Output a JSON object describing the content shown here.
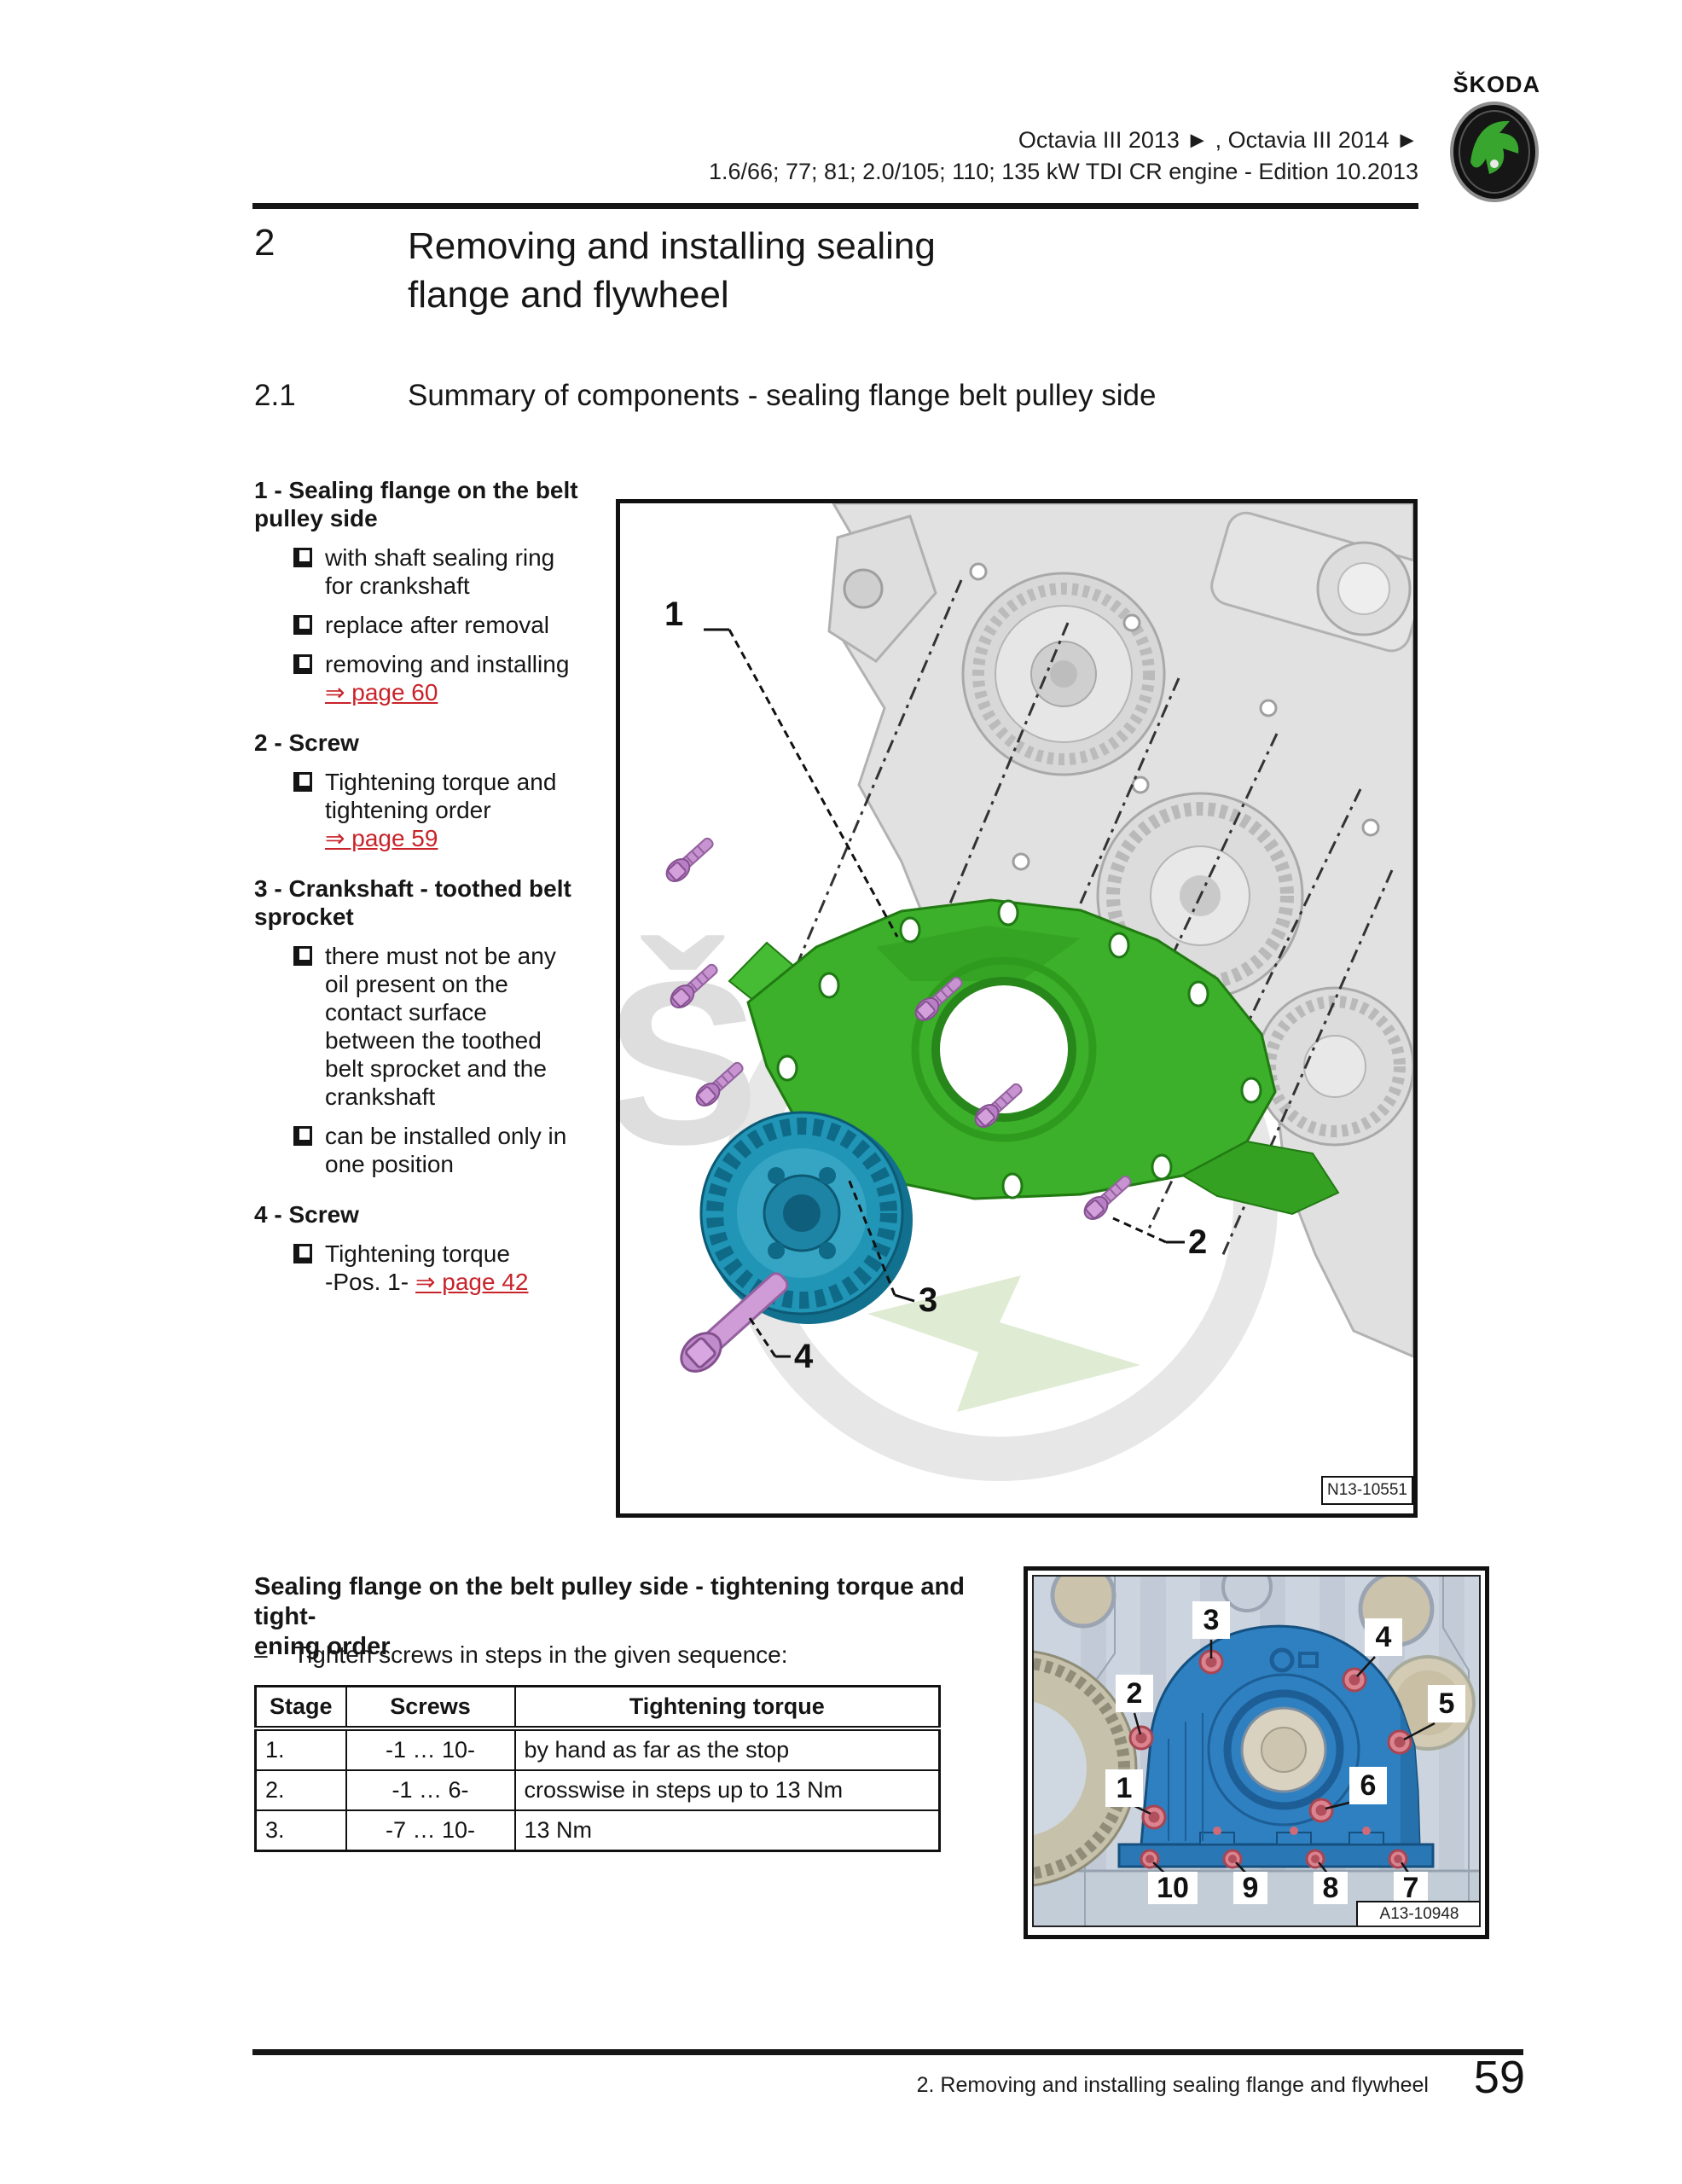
{
  "header": {
    "brand": "ŠKODA",
    "model_line": "Octavia III 2013 ► , Octavia III 2014 ►",
    "engine_line": "1.6/66; 77; 81; 2.0/105; 110; 135 kW TDI CR engine - Edition 10.2013"
  },
  "section": {
    "number": "2",
    "title_line1": "Removing and installing sealing",
    "title_line2": "flange and flywheel"
  },
  "subsection": {
    "number": "2.1",
    "title": "Summary of components - sealing flange belt pulley side"
  },
  "legend": {
    "items": [
      {
        "label": "1 - Sealing flange on the belt pulley side",
        "bullets": [
          {
            "text": "with shaft sealing ring for crankshaft"
          },
          {
            "text": "replace after removal"
          },
          {
            "text": "removing and installing",
            "link": "⇒ page 60"
          }
        ]
      },
      {
        "label": "2 - Screw",
        "bullets": [
          {
            "text": "Tightening torque and tightening order",
            "link": "⇒ page 59"
          }
        ]
      },
      {
        "label": "3 - Crankshaft - toothed belt sprocket",
        "bullets": [
          {
            "text": "there must not be any oil present on the contact surface between the toothed belt sprocket and the crankshaft"
          },
          {
            "text": "can be installed only in one position"
          }
        ]
      },
      {
        "label": "4 - Screw",
        "bullets": [
          {
            "text": "Tightening torque",
            "pos": "-Pos. 1-",
            "link": "⇒ page 42"
          }
        ]
      }
    ]
  },
  "figure1": {
    "watermark": "Š",
    "callouts": [
      "1",
      "2",
      "3",
      "4"
    ],
    "ref": "N13-10551"
  },
  "torque": {
    "heading_line1": "Sealing flange on the belt pulley side - tightening torque and tight-",
    "heading_line2": "ening order",
    "dash": "–",
    "instruction": "Tighten screws in steps in the given sequence:",
    "table": {
      "headers": [
        "Stage",
        "Screws",
        "Tightening torque"
      ],
      "rows": [
        {
          "stage": "1.",
          "screws": "-1 … 10-",
          "torque": "by hand as far as the stop"
        },
        {
          "stage": "2.",
          "screws": "-1 … 6-",
          "torque": "crosswise in steps up to 13 Nm"
        },
        {
          "stage": "3.",
          "screws": "-7 … 10-",
          "torque": "13 Nm"
        }
      ]
    }
  },
  "figure2": {
    "callouts": [
      "1",
      "2",
      "3",
      "4",
      "5",
      "6",
      "7",
      "8",
      "9",
      "10"
    ],
    "ref": "A13-10948"
  },
  "footer": {
    "chapter": "2. Removing and installing sealing flange and flywheel",
    "page": "59"
  },
  "colors": {
    "link_red": "#c8232a",
    "flange_green": "#3cb02a",
    "sprocket_teal": "#2095b6",
    "screw_purple": "#c793d1",
    "flange_blue": "#2e80c1",
    "screw_pink": "#db8490",
    "brand_green": "#37a52e"
  }
}
